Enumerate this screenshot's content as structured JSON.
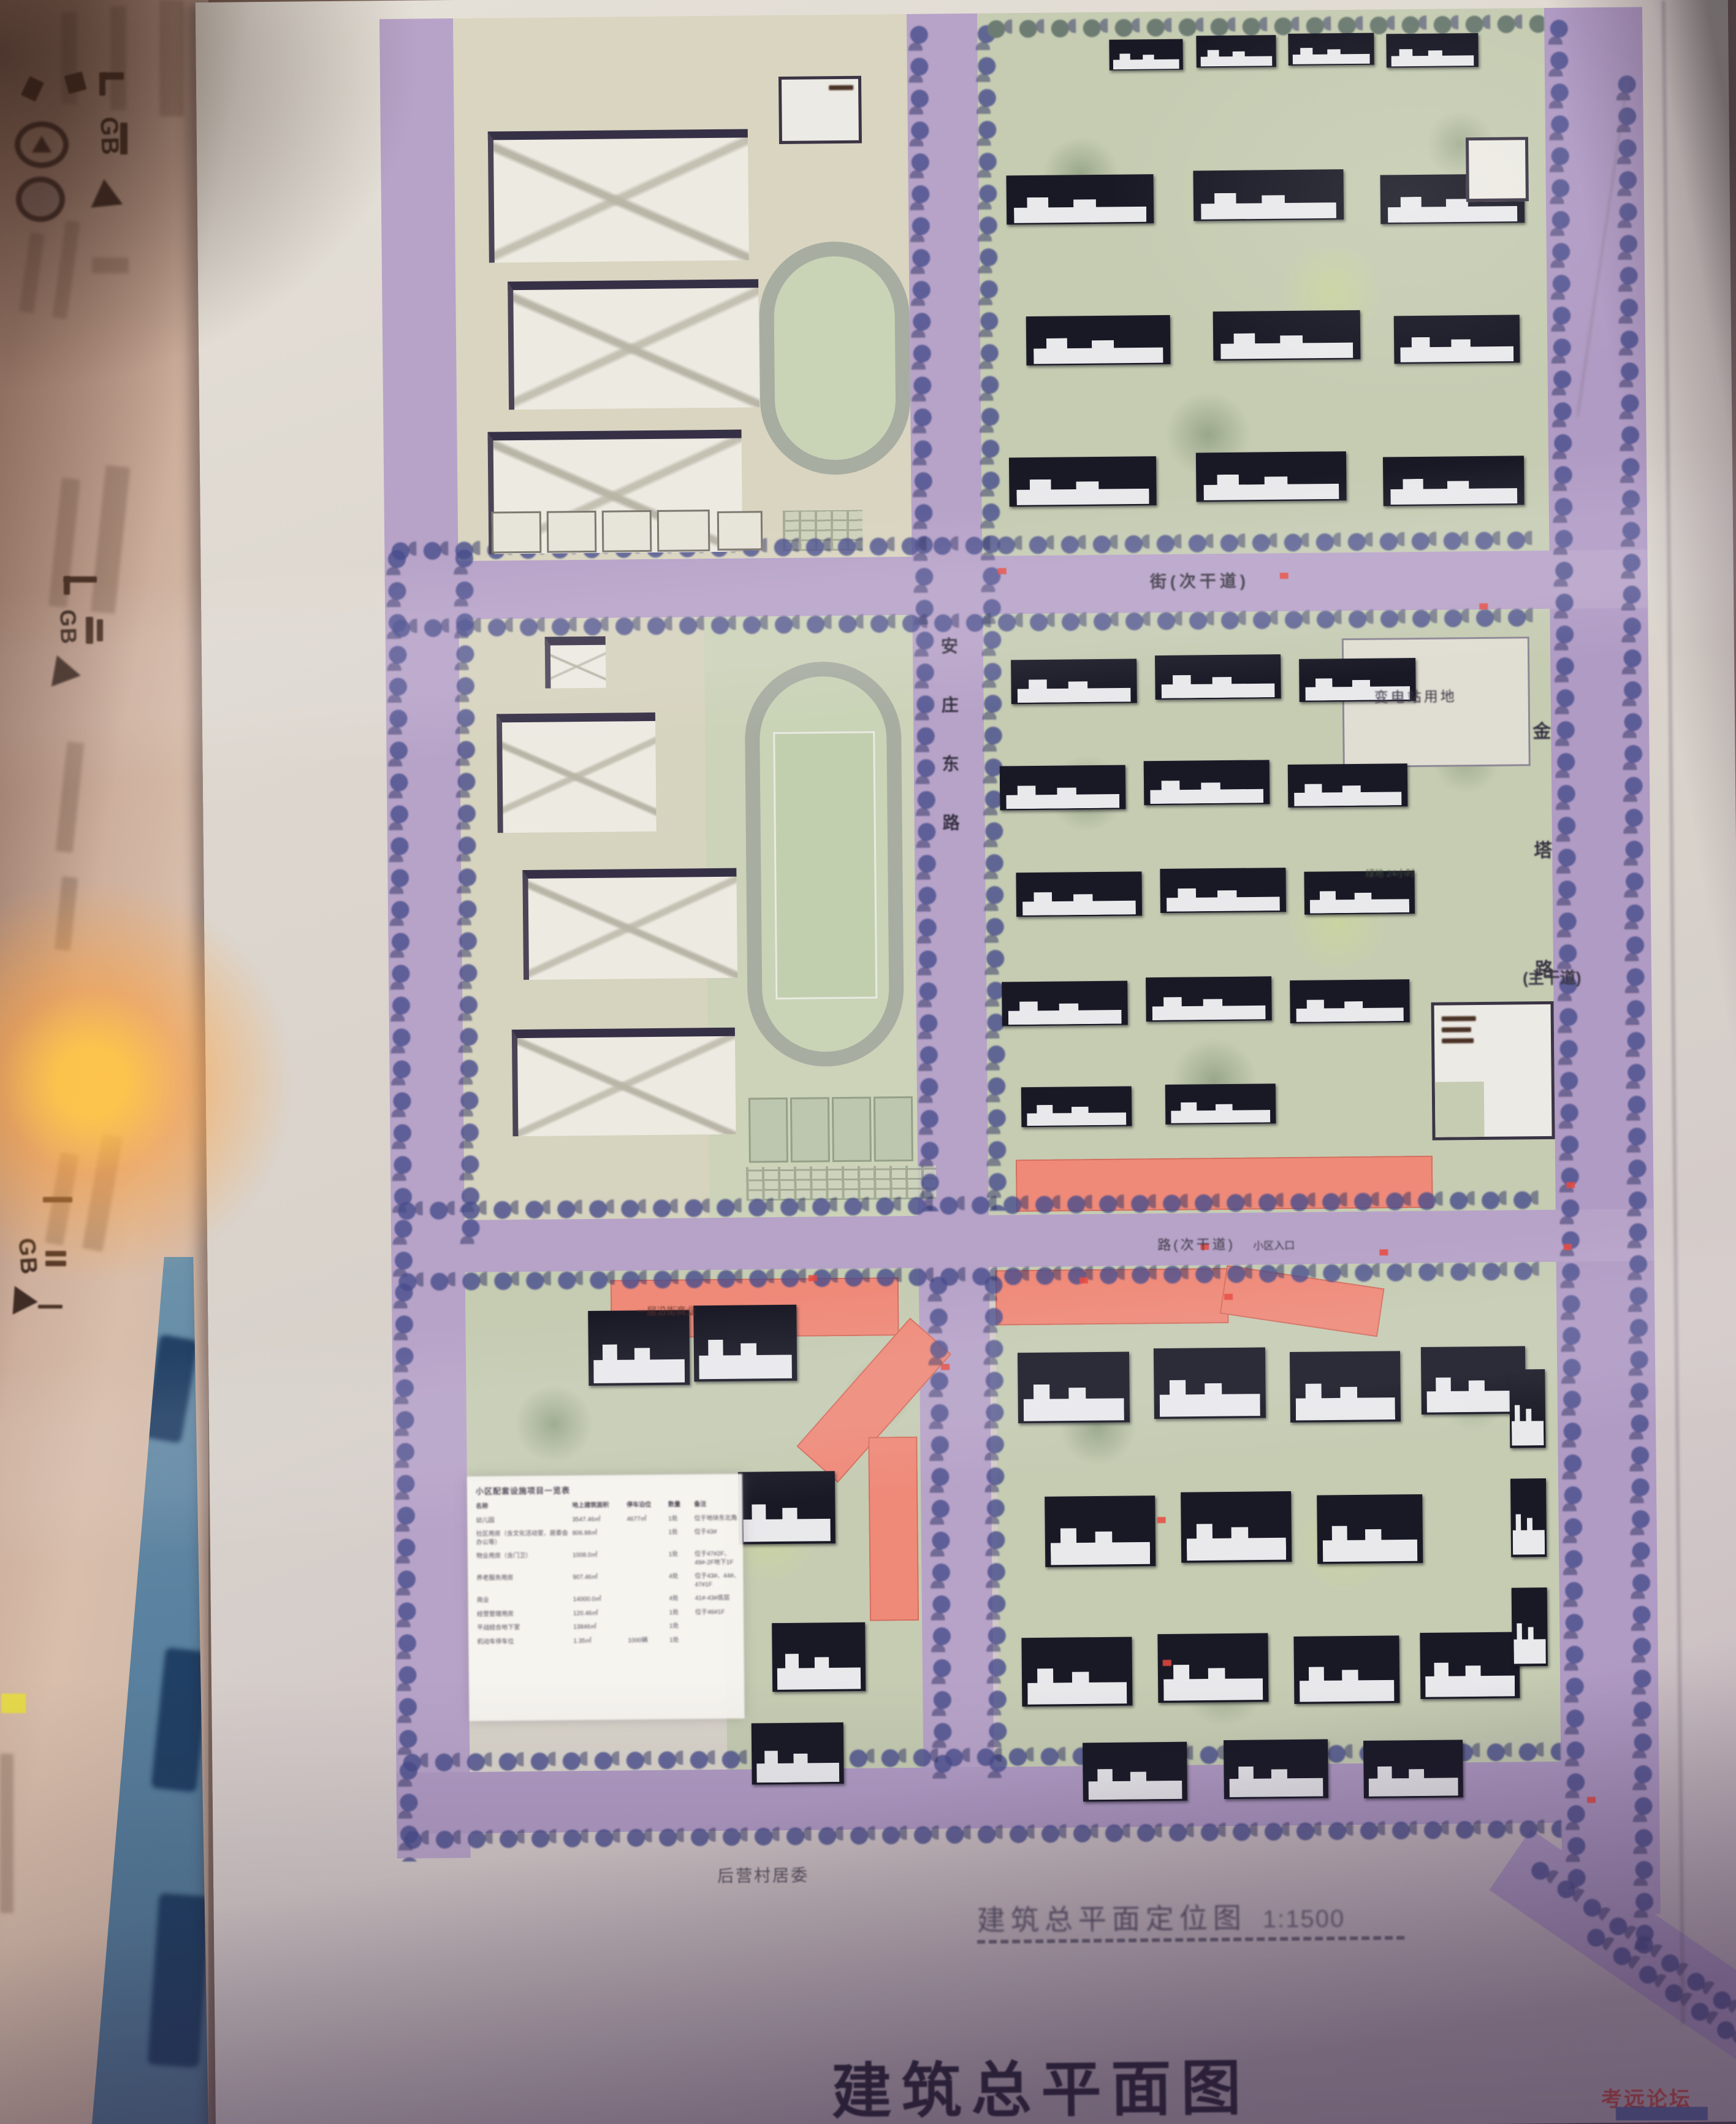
{
  "watermark": {
    "text": "考远论坛"
  },
  "left_poster": {
    "gb": "GB"
  },
  "plan": {
    "title": "建筑总平面图",
    "drawing_label": "建筑总平面定位图",
    "drawing_scale": "1:1500",
    "roads": {
      "jinta": {
        "chars": [
          "金",
          "塔",
          "路"
        ],
        "class_label": "(主干道)"
      },
      "anzhuang": {
        "chars": [
          "安",
          "庄",
          "东",
          "路"
        ]
      },
      "top": {
        "label": "街(次干道)"
      },
      "middle": {
        "label": "路(次干道)",
        "entrance": "小区入口"
      }
    },
    "sites": {
      "substation": "变电站用地",
      "green24": "绿地 24小时",
      "village": "后营村居委",
      "shops": "一层沿街商业"
    },
    "table": {
      "title": "小区配套设施项目一览表",
      "headers": [
        "名称",
        "地上建筑面积",
        "停车泊位",
        "数量",
        "备注"
      ],
      "rows": [
        [
          "幼儿园",
          "3547.46㎡",
          "4677㎡",
          "1处",
          "位于地块东北角"
        ],
        [
          "社区用房（含文化活动室、居委会办公等）",
          "806.88㎡",
          "",
          "1处",
          "位于43#"
        ],
        [
          "物业用房（含门卫）",
          "1008.0㎡",
          "",
          "1处",
          "位于47#2F、49#-2F地下1F"
        ],
        [
          "养老服务用房",
          "907.46㎡",
          "",
          "4处",
          "位于43#、44#、47#1F"
        ],
        [
          "商业",
          "14000.0㎡",
          "",
          "4处",
          "41#-43#底层"
        ],
        [
          "经营管理用房",
          "120.46㎡",
          "",
          "1处",
          "位于46#1F"
        ],
        [
          "平战结合地下室",
          "13846㎡",
          "",
          "1处",
          ""
        ],
        [
          "机动车停车位",
          "1.35㎡",
          "1000辆",
          "1处",
          ""
        ]
      ]
    }
  },
  "colors": {
    "road": "#b7a3c8",
    "tree": "#484d8c",
    "block_green": "#c5ccb2",
    "school_cream": "#d9d5c0",
    "commercial_pink": "#ef8a79",
    "paper": "#d9d4cd",
    "title_ink": "#232031",
    "red_mark": "#e8493e",
    "track_grey": "#a7ada1",
    "blue_band": "#5b82a0",
    "glare_orange": "#ffc448"
  }
}
